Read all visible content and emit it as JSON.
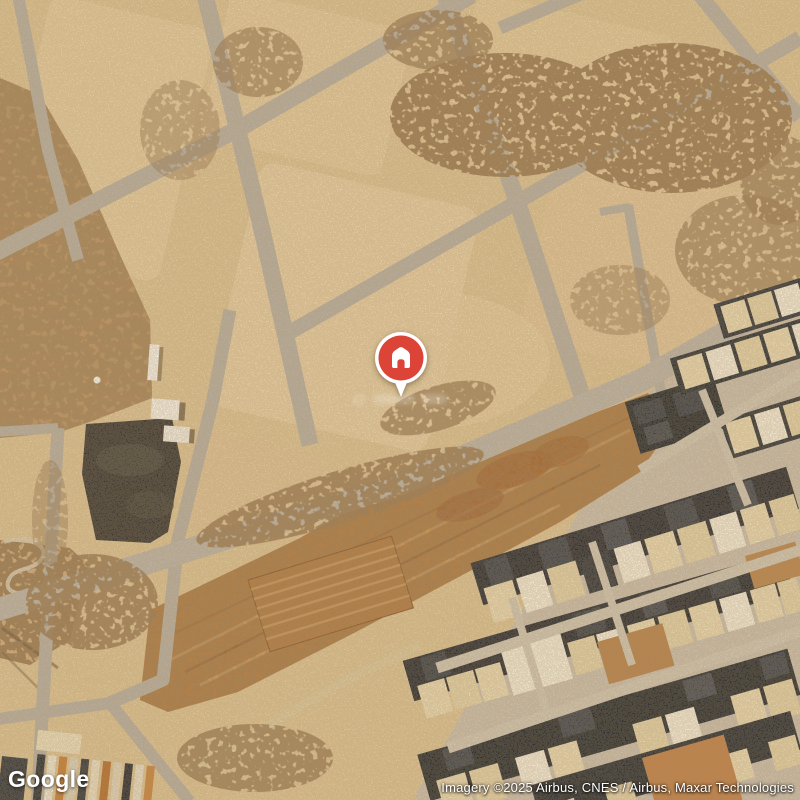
{
  "map": {
    "provider_logo": "Google",
    "attribution": "Imagery ©2025 Airbus, CNES / Airbus, Maxar Technologies",
    "faint_watermark": "@",
    "pin": {
      "type": "property-location-marker",
      "icon": "house-icon",
      "pin_color": "#DB4437",
      "stem_color": "#FFFFFF",
      "glyph_color": "#FFFFFF"
    }
  },
  "palette": {
    "sand": "#DCC294",
    "sand_light": "#EAD5AB",
    "road_gray": "#B6AEA1",
    "dirt_brown": "#B07B41",
    "dune_brown": "#B98F5F",
    "dark_field": "#3A3834",
    "building_dark": "#2C2F33",
    "building_cream": "#E7D7B0",
    "building_white": "#F1EAD6",
    "logo_text": "#FFFFFF",
    "attribution_text": "#FFFFFF"
  }
}
